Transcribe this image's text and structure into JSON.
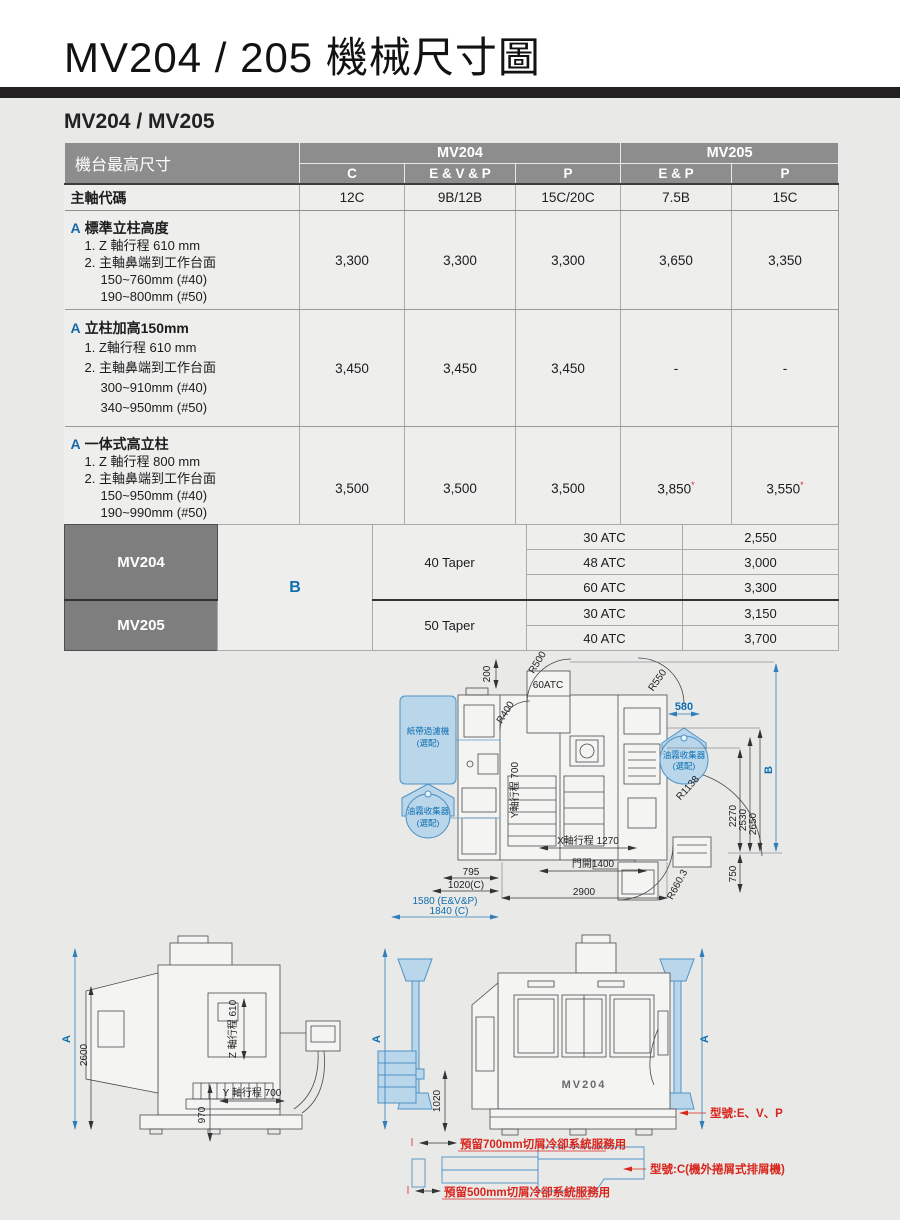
{
  "header": {
    "title": "MV204 / 205 機械尺寸圖",
    "section": "MV204 / MV205"
  },
  "spec_table": {
    "corner": "機台最高尺寸",
    "group_mv204": "MV204",
    "group_mv205": "MV205",
    "columns": [
      "C",
      "E & V & P",
      "P",
      "E & P",
      "P"
    ],
    "spindle_label": "主軸代碼",
    "spindle_values": [
      "12C",
      "9B/12B",
      "15C/20C",
      "7.5B",
      "15C"
    ],
    "blocks": [
      {
        "marker": "A",
        "title": "標準立柱高度",
        "lines": [
          "1. Z 軸行程 610 mm",
          "2. 主軸鼻端到工作台面",
          "150~760mm (#40)",
          "190~800mm (#50)"
        ],
        "values": [
          "3,300",
          "3,300",
          "3,300",
          "3,650",
          "3,350"
        ]
      },
      {
        "marker": "A",
        "title": "立柱加高150mm",
        "lines": [
          "1. Z軸行程 610 mm",
          "2. 主軸鼻端到工作台面",
          "300~910mm (#40)",
          "340~950mm (#50)"
        ],
        "values": [
          "3,450",
          "3,450",
          "3,450",
          "-",
          "-"
        ]
      },
      {
        "marker": "A",
        "title": "一体式高立柱",
        "lines": [
          "1. Z 軸行程 800 mm",
          "2. 主軸鼻端到工作台面",
          "150~950mm (#40)",
          "190~990mm (#50)"
        ],
        "values": [
          "3,500",
          "3,500",
          "3,500",
          "3,850",
          "3,550"
        ]
      }
    ],
    "star": "*",
    "footnote": "機台無法裝櫃"
  },
  "atc_table": {
    "model_mv204": "MV204",
    "model_mv205": "MV205",
    "b": "B",
    "taper40": "40 Taper",
    "taper50": "50 Taper",
    "rows": [
      {
        "atc": "30 ATC",
        "value": "2,550"
      },
      {
        "atc": "48 ATC",
        "value": "3,000"
      },
      {
        "atc": "60 ATC",
        "value": "3,300"
      },
      {
        "atc": "30 ATC",
        "value": "3,150"
      },
      {
        "atc": "40 ATC",
        "value": "3,700"
      }
    ]
  },
  "top_view": {
    "d200": "200",
    "r500": "R500",
    "atc60": "60ATC",
    "r400": "R400",
    "r550": "R550",
    "d580": "580",
    "paper_filter": "紙帶過濾機",
    "oil_mist": "油霧收集器",
    "optional": "(選配)",
    "r1138": "R1138",
    "d2270": "2270",
    "d2530": "2530",
    "d2650": "2650",
    "b": "B",
    "y_axis": "Y軸行程 700",
    "x_axis": "X軸行程 1270",
    "d795": "795",
    "d1020c": "1020(C)",
    "d1580": "1580 (E&V&P)",
    "d1840": "1840 (C)",
    "door": "門開1400",
    "d2900": "2900",
    "d750": "750",
    "r660": "R660.3"
  },
  "side_view": {
    "a": "A",
    "d2600": "2600",
    "z_axis": "Z 軸行程 610",
    "d970": "970",
    "y_axis": "Y 軸行程 700"
  },
  "front_view": {
    "a": "A",
    "d1020": "1020",
    "model": "MV204",
    "reserve700": "預留700mm切屑冷卻系統服務用",
    "type_evp": "型號:E、V、P",
    "type_c": "型號:C(機外捲屑式排屑機)",
    "reserve500": "預留500mm切屑冷卻系統服務用"
  }
}
